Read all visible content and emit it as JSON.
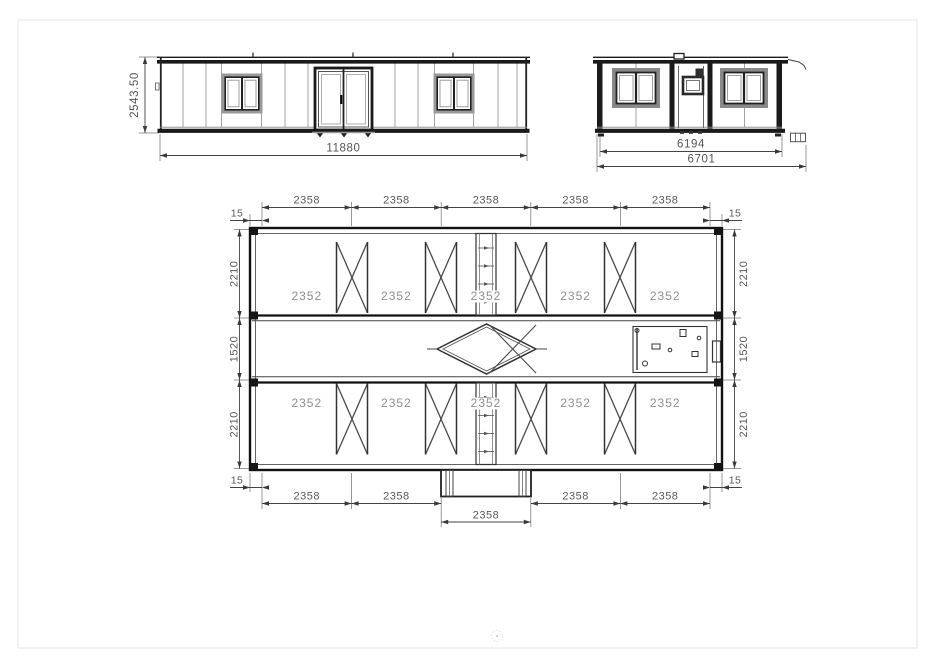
{
  "views": {
    "side_elevation": {
      "height_dim": "2543.50",
      "width_dim": "11880"
    },
    "end_elevation": {
      "inner_width_dim": "6194",
      "outer_width_dim": "6701"
    },
    "plan": {
      "offset_dims": [
        "15",
        "15",
        "15",
        "15"
      ],
      "top_dims": [
        "2358",
        "2358",
        "2358",
        "2358",
        "2358"
      ],
      "bottom_dims": [
        "2358",
        "2358",
        "2358",
        "2358"
      ],
      "bottom_center_dim": "2358",
      "left_dims": [
        "2210",
        "1520",
        "2210"
      ],
      "right_dims": [
        "2210",
        "1520",
        "2210"
      ],
      "top_bay_dims": [
        "2352",
        "2352",
        "2352",
        "2352",
        "2352"
      ],
      "bottom_bay_dims": [
        "2352",
        "2352",
        "2352",
        "2352",
        "2352"
      ]
    }
  },
  "colors": {
    "line": "#1a1a1a",
    "thin_line": "#777777",
    "dim_text": "#5a5a5a",
    "bay_text": "#8f8f8f",
    "page_border": "#e4e4e4"
  }
}
